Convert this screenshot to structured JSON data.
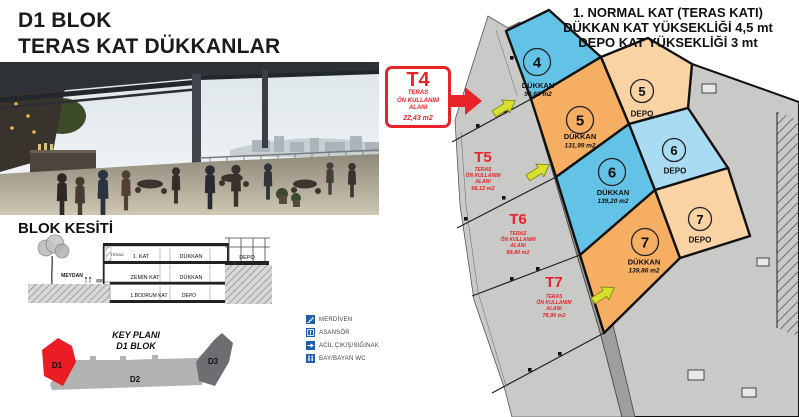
{
  "header": {
    "title_line1": "D1 BLOK",
    "title_line2": "TERAS KAT DÜKKANLAR"
  },
  "info_note": {
    "line1": "1. NORMAL KAT (TERAS KATI)",
    "line2": "DÜKKAN KAT YÜKSEKLİĞİ 4,5 mt",
    "line3": "DEPO KAT YÜKSEKLİĞİ 3 mt"
  },
  "t4": {
    "code": "T4",
    "line1": "TERAS",
    "line2": "ÖN KULLANIM",
    "line3": "ALANI",
    "area": "22,43 m2"
  },
  "plan": {
    "terraces": [
      {
        "code": "T5",
        "line1": "TERAS",
        "line2": "ÖN KULLANIM",
        "line3": "ALANI",
        "area": "68,12 m2"
      },
      {
        "code": "T6",
        "line1": "TERAS",
        "line2": "ÖN KULLANIM",
        "line3": "ALANI",
        "area": "89,40 m2"
      },
      {
        "code": "T7",
        "line1": "TERAS",
        "line2": "ÖN KULLANIM",
        "line3": "ALANI",
        "area": "78,90 m2"
      }
    ],
    "shops": {
      "d4": {
        "num": "4",
        "label": "DÜKKAN",
        "area": "98,63 m2"
      },
      "d5": {
        "num": "5",
        "label": "DÜKKAN",
        "area": "131,99 m2"
      },
      "d6": {
        "num": "6",
        "label": "DÜKKAN",
        "area": "139,20 m2"
      },
      "d7": {
        "num": "7",
        "label": "DÜKKAN",
        "area": "139,86 m2"
      },
      "depo5": {
        "num": "5",
        "label": "DEPO"
      },
      "depo6": {
        "num": "6",
        "label": "DEPO"
      },
      "depo7": {
        "num": "7",
        "label": "DEPO"
      }
    }
  },
  "section": {
    "heading": "BLOK KESİTİ",
    "meydan": "MEYDAN",
    "teras": "TERAS",
    "floor1_label": "1. KAT",
    "floor1_use": "DÜKKAN",
    "upper_depo": "DEPO",
    "ground_label": "ZEMİN KAT",
    "ground_use": "DÜKKAN",
    "basement_label": "1.BODRUM KAT",
    "basement_use": "DEPO"
  },
  "key_plan": {
    "title_line1": "KEY PLANI",
    "title_line2": "D1 BLOK",
    "blocks": [
      {
        "label": "D1",
        "color": "#ec1c24"
      },
      {
        "label": "D2",
        "color": "#b2b2b2"
      },
      {
        "label": "D3",
        "color": "#6d6e71"
      }
    ]
  },
  "legend": {
    "items": [
      {
        "icon": "stairs-icon",
        "label": "MERDİVEN"
      },
      {
        "icon": "elevator-icon",
        "label": "ASANSÖR"
      },
      {
        "icon": "emergency-exit-icon",
        "label": "ACİL ÇIKIŞ/SIĞINAK"
      },
      {
        "icon": "wc-icon",
        "label": "BAY/BAYAN WC"
      }
    ]
  },
  "colors": {
    "accent_red": "#e8232a",
    "dukkan_blue": "#63c3e6",
    "depo_blue": "#a9dcf2",
    "dukkan_orange": "#f6ae63",
    "depo_orange": "#fad3a5",
    "terrace_gray": "#c9c9c7",
    "walkway_gray": "#9e9e9c",
    "legend_blue": "#1e5ea9",
    "arrow_yellow": "#d7e02f"
  }
}
